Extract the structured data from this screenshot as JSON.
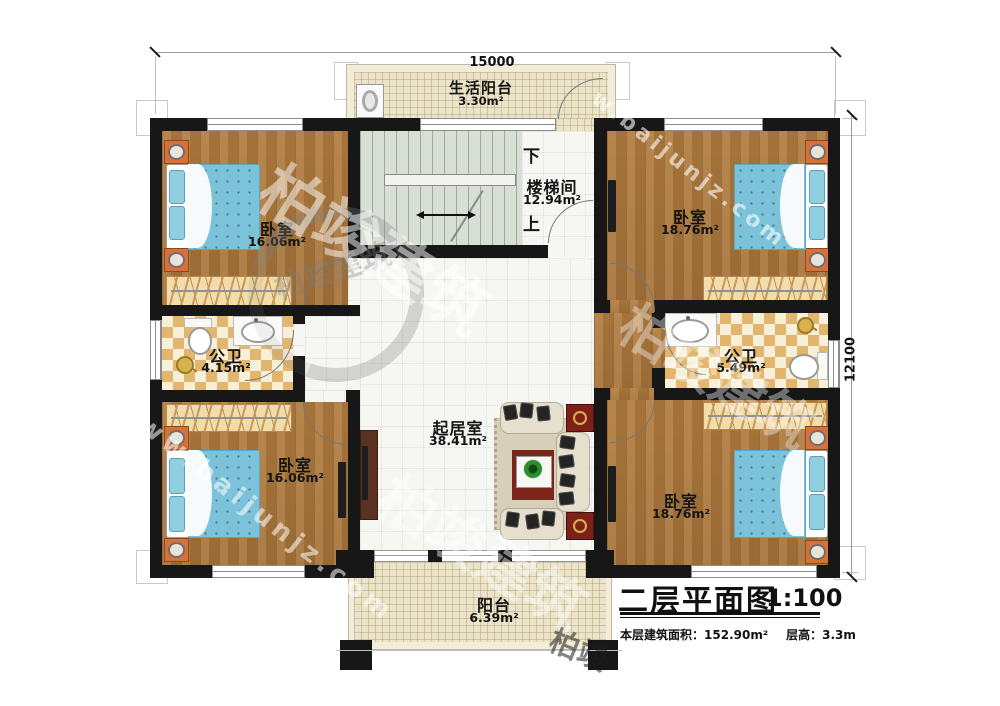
{
  "dimensions": {
    "top": "15000",
    "right": "12100"
  },
  "title_block": {
    "title": "二层平面图",
    "scale": "1:100",
    "area_label": "本层建筑面积：",
    "area_value": "152.90m²",
    "floor_height_label": "层高：",
    "floor_height_value": "3.3m"
  },
  "rooms": {
    "life_balcony": {
      "name": "生活阳台",
      "area": "3.30m²"
    },
    "stairwell": {
      "name": "楼梯间",
      "area": "12.94m²",
      "down": "下",
      "up": "上"
    },
    "bedroom_top_left": {
      "name": "卧室",
      "area": "16.06m²"
    },
    "bedroom_top_right": {
      "name": "卧室",
      "area": "18.76m²"
    },
    "bath_left": {
      "name": "公卫",
      "area": "4.15m²"
    },
    "bath_right": {
      "name": "公卫",
      "area": "5.49m²"
    },
    "living_room": {
      "name": "起居室",
      "area": "38.41m²"
    },
    "bedroom_bottom_left": {
      "name": "卧室",
      "area": "16.06m²"
    },
    "bedroom_bottom_right": {
      "name": "卧室",
      "area": "18.76m²"
    },
    "balcony": {
      "name": "阳台",
      "area": "6.39m²"
    }
  },
  "watermark": {
    "site": "www.baijunjz.com",
    "site_short": "w.baijunjz.com",
    "brand": "柏竣建筑",
    "brand_short": "柏竣"
  },
  "colors": {
    "wall": "#171717",
    "wood_floor": "#ad793c",
    "bed_blue": "#7cc3da",
    "tile_checker": "#e3b670",
    "rug_red": "#7d241b"
  }
}
